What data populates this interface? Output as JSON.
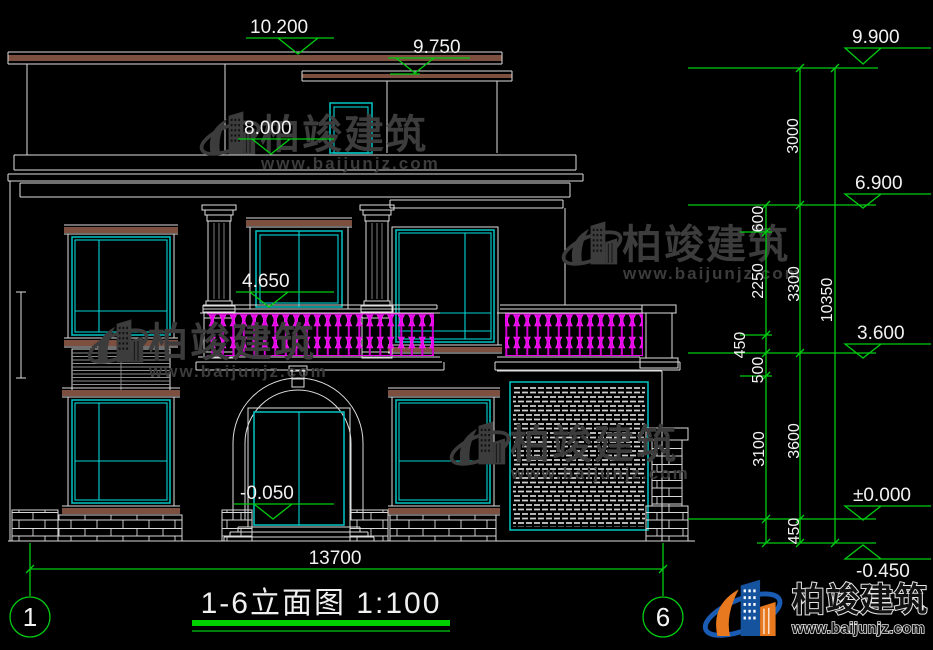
{
  "title": {
    "text": "1-6立面图 1:100"
  },
  "axes": {
    "left": "1",
    "right": "6"
  },
  "levels": {
    "left": [
      "10.200",
      "9.750",
      "8.000",
      "4.650",
      "-0.050"
    ],
    "right": [
      "9.900",
      "6.900",
      "3.600",
      "±0.000",
      "-0.450"
    ]
  },
  "dims": {
    "bottom_width": "13700",
    "overall": "10350",
    "inner_chain": [
      "600",
      "2250",
      "450",
      "500",
      "3100"
    ],
    "middle_chain": [
      "3000",
      "3300",
      "3600",
      "450"
    ]
  },
  "watermark": {
    "name": "柏竣建筑",
    "url": "www.baijunjz.com"
  },
  "brand": {
    "name": "柏竣建筑",
    "url": "www.baijunjz.com"
  }
}
